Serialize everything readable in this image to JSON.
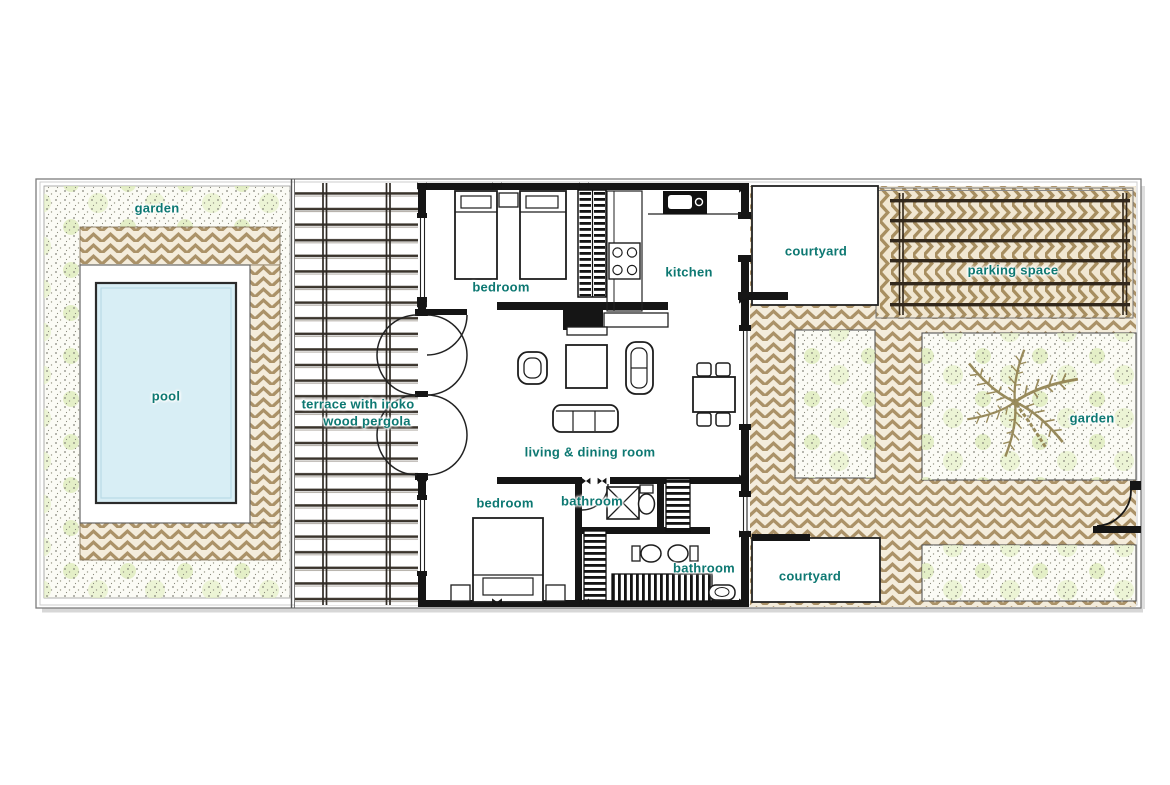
{
  "document": {
    "type": "villa floor plan drawing"
  },
  "labels": {
    "garden_left": "garden",
    "pool": "pool",
    "terrace_line1": "terrace with iroko",
    "terrace_line2": "wood pergola",
    "bedroom_top": "bedroom",
    "kitchen": "kitchen",
    "courtyard_top": "courtyard",
    "parking": "parking space",
    "living_dining": "living & dining room",
    "bedroom_bottom": "bedroom",
    "bathroom_main": "bathroom",
    "bathroom_guest": "bathroom",
    "courtyard_bottom": "courtyard",
    "garden_right": "garden"
  },
  "colors": {
    "label_teal": "#0d7872",
    "wall_black": "#151515",
    "paving_tan": "#ab9268",
    "paving_bg": "#f4ecdb",
    "pool_blue": "#d8eef5",
    "pergola_beam": "#3a342c",
    "garden_dot": "#85857a",
    "garden_blotch": "#dcebb8"
  }
}
